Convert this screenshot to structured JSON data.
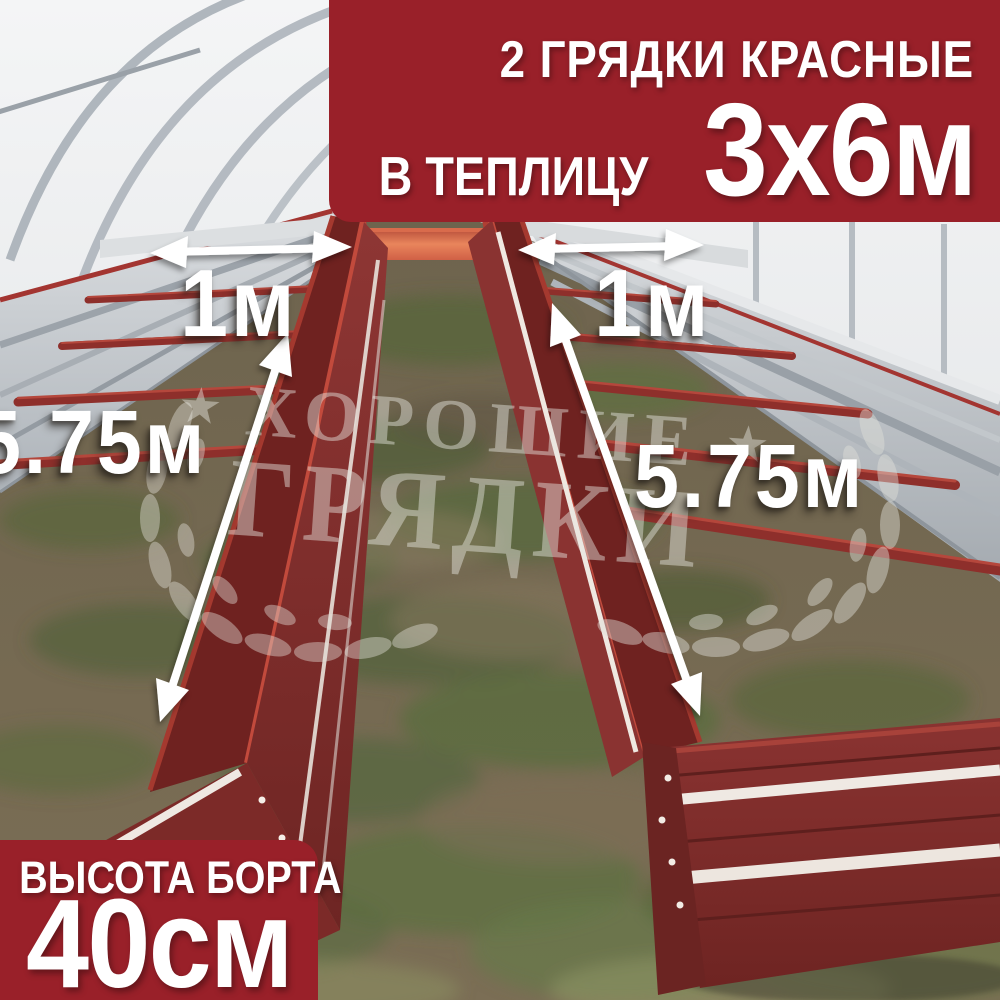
{
  "top_banner": {
    "line1": "2 ГРЯДКИ КРАСНЫЕ",
    "line2_label": "В ТЕПЛИЦУ",
    "line2_value": "3х6м"
  },
  "bottom_banner": {
    "label": "ВЫСОТА БОРТА",
    "value": "40см"
  },
  "measurements": {
    "left_bed_width": "1м",
    "right_bed_width": "1м",
    "left_bed_length": "5.75м",
    "right_bed_length": "5.75м"
  },
  "watermark": {
    "word_top": "ХОРОШИЕ",
    "word_bottom": "ГРЯДКИ",
    "star": "★"
  },
  "icons": {
    "width_arrow": "↔ double-headed horizontal arrow",
    "length_arrow": "⤢ double-headed diagonal arrow",
    "laurel_branch": "laurel wreath branch",
    "star": "★"
  },
  "colors": {
    "banner_red": "#992029",
    "bed_red": "#7E2B29",
    "bed_red_bright": "#C24A3C",
    "end_panel_orange": "#E07A52",
    "galvanized_silver": "#C9CDD1",
    "wall_white": "#EEF0F1",
    "ground_brown": "#75684F",
    "grass_green": "#5E6C3D",
    "label_white": "#FFFFFF"
  }
}
